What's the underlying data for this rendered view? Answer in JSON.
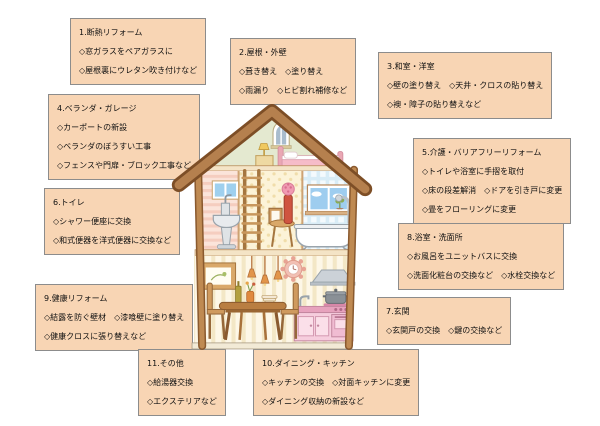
{
  "palette": {
    "box_fill": "#f8d5b4",
    "box_border": "#8c8c8c",
    "text_color": "#111111",
    "roof_brown": "#b5804e",
    "roof_outline": "#7d4e26",
    "attic_green": "#e4e9d0",
    "wall_pink": "#fbe4da",
    "wall_cream_dots": "#fcf3d8",
    "wall_blue_check": "#d8ecf6",
    "wall_stripe_cream": "#fdf7e7",
    "kitchen_pink": "#f6cddd"
  },
  "boxes": [
    {
      "id": "1",
      "title": "1.断熱リフォーム",
      "lines": [
        "◇窓ガラスをペアガラスに",
        "◇屋根裏にウレタン吹き付けなど"
      ]
    },
    {
      "id": "2",
      "title": "2.屋根・外壁",
      "lines": [
        "◇葺き替え　◇塗り替え",
        "◇雨漏り　◇ヒビ割れ補修など"
      ]
    },
    {
      "id": "3",
      "title": "3.和室・洋室",
      "lines": [
        "◇壁の塗り替え　◇天井・クロスの貼り替え",
        "◇襖・障子の貼り替えなど"
      ]
    },
    {
      "id": "4",
      "title": "4.ベランダ・ガレージ",
      "lines": [
        "◇カーポートの新設",
        "◇ベランダのぼうすい工事",
        "◇フェンスや門扉・ブロック工事など"
      ]
    },
    {
      "id": "5",
      "title": "5.介護・バリアフリーリフォーム",
      "lines": [
        "◇トイレや浴室に手摺を取付",
        "◇床の段差解消　◇ドアを引き戸に変更",
        "◇畳をフローリングに変更"
      ]
    },
    {
      "id": "6",
      "title": "6.トイレ",
      "lines": [
        "◇シャワー便座に交換",
        "◇和式便器を洋式便器に交換など"
      ]
    },
    {
      "id": "7",
      "title": "7.玄関",
      "lines": [
        "◇玄関戸の交換　◇鍵の交換など"
      ]
    },
    {
      "id": "8",
      "title": "8.浴室・洗面所",
      "lines": [
        "◇お風呂をユニットバスに交換",
        "◇洗面化粧台の交換など　◇水栓交換など"
      ]
    },
    {
      "id": "9",
      "title": "9.健康リフォーム",
      "lines": [
        "◇結露を防ぐ壁材　◇漆喰壁に塗り替え",
        "◇健康クロスに張り替えなど"
      ]
    },
    {
      "id": "10",
      "title": "10.ダイニング・キッチン",
      "lines": [
        "◇キッチンの交換　◇対面キッチンに変更",
        "◇ダイニング収納の新設など"
      ]
    },
    {
      "id": "11",
      "title": "11.その他",
      "lines": [
        "◇給湯器交換",
        "◇エクステリアなど"
      ]
    }
  ],
  "house": {
    "parts": [
      "roof",
      "attic-bedroom",
      "attic-window",
      "bedside-lamp",
      "bed",
      "toilet-room",
      "toilet-window",
      "wash-toilet",
      "ladder",
      "stool-and-vase",
      "bathroom",
      "bathroom-window",
      "bathtub",
      "shower",
      "dining-room",
      "picture-frame",
      "pendant-lights",
      "wall-clock",
      "range-hood",
      "cooking-pot",
      "kitchen-counter",
      "dining-table",
      "chairs"
    ]
  }
}
